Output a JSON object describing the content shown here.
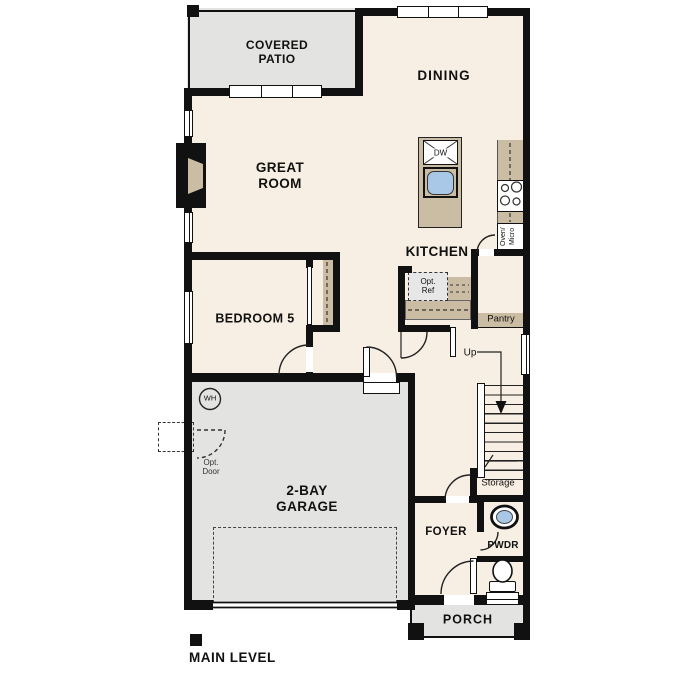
{
  "plan_title": "MAIN LEVEL",
  "rooms": {
    "covered_patio": "COVERED\nPATIO",
    "dining": "DINING",
    "great_room": "GREAT\nROOM",
    "kitchen": "KITCHEN",
    "bedroom_5": "BEDROOM 5",
    "garage": "2-BAY\nGARAGE",
    "foyer": "FOYER",
    "powder": "PWDR",
    "porch": "PORCH"
  },
  "annotations": {
    "pantry": "Pantry",
    "storage": "Storage",
    "stairs_up": "Up",
    "water_heater": "WH",
    "dishwasher": "DW",
    "optional_refrigerator": "Opt.\nRef",
    "optional_door": "Opt.\nDoor",
    "oven_microwave": "Oven/\nMicro"
  },
  "colors": {
    "wall": "#111111",
    "interior_floor": "#f7efe3",
    "exterior_concrete": "#e3e3e1",
    "counter_tan": "#cbbda4",
    "sink_blue": "#a9c7e7",
    "appliance_gray": "#e7e7e7"
  }
}
